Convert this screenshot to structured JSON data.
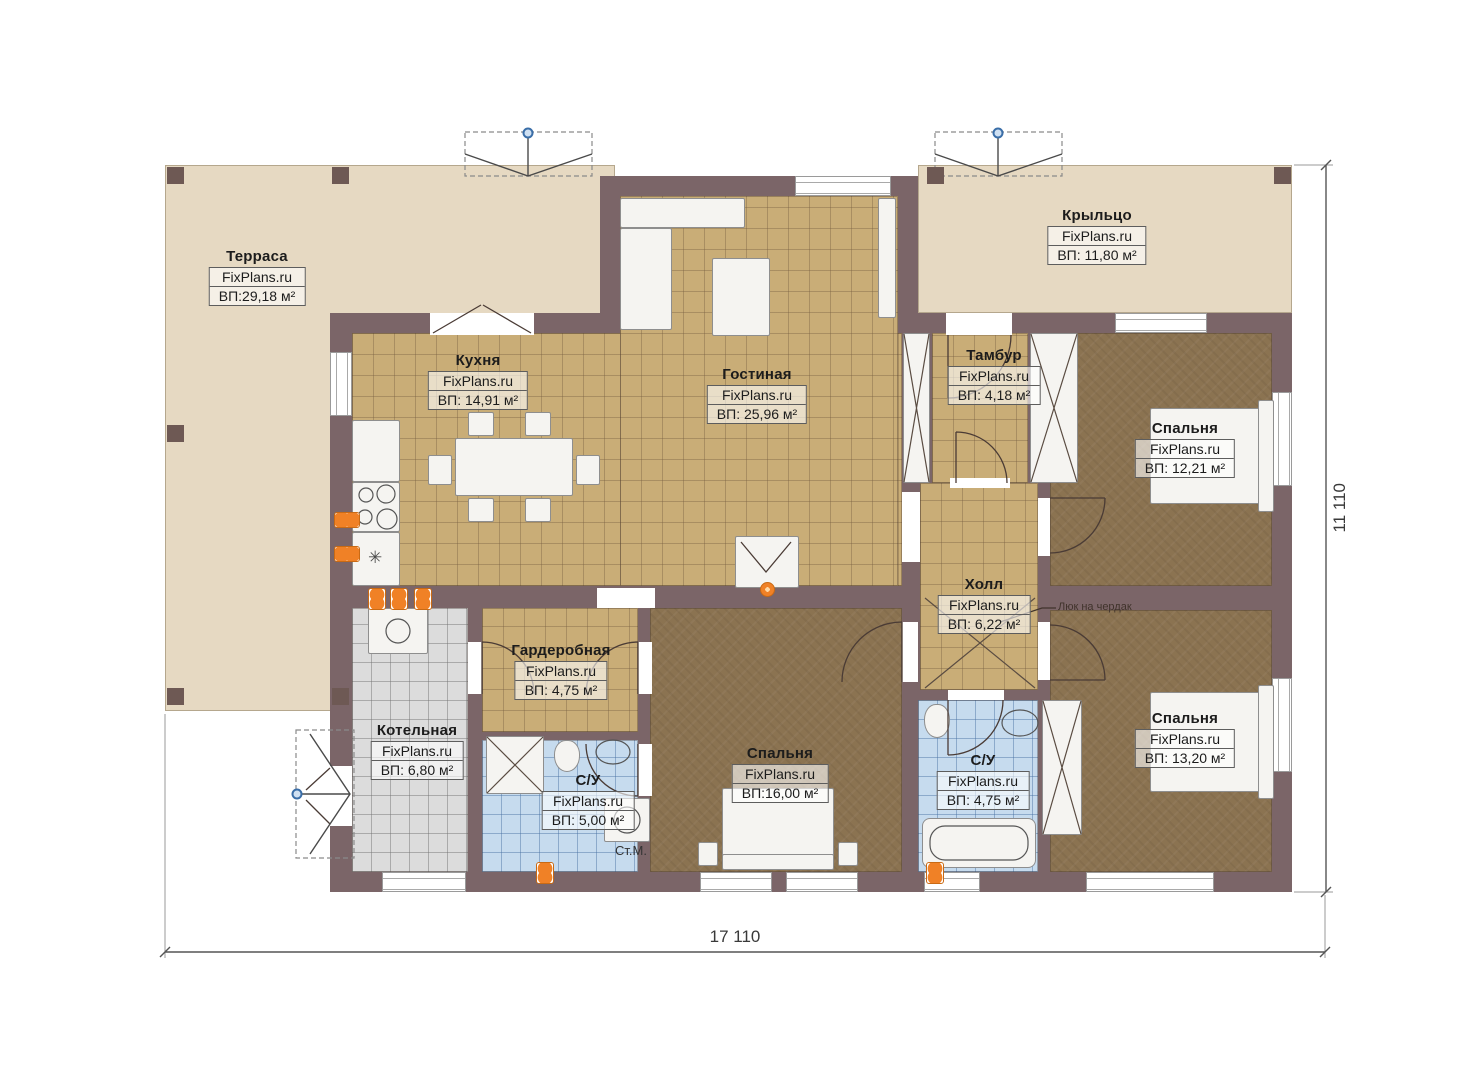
{
  "plan": {
    "brand": "FixPlans.ru",
    "rooms": [
      {
        "key": "terrace",
        "name": "Терраса",
        "area": "ВП:29,18 м²"
      },
      {
        "key": "porch",
        "name": "Крыльцо",
        "area": "ВП: 11,80 м²"
      },
      {
        "key": "kitchen",
        "name": "Кухня",
        "area": "ВП: 14,91 м²"
      },
      {
        "key": "living",
        "name": "Гостиная",
        "area": "ВП: 25,96 м²"
      },
      {
        "key": "vestibule",
        "name": "Тамбур",
        "area": "ВП: 4,18 м²"
      },
      {
        "key": "bedroom-1",
        "name": "Спальня",
        "area": "ВП: 12,21 м²"
      },
      {
        "key": "hall",
        "name": "Холл",
        "area": "ВП: 6,22 м²"
      },
      {
        "key": "wardrobe",
        "name": "Гардеробная",
        "area": "ВП: 4,75 м²"
      },
      {
        "key": "boiler",
        "name": "Котельная",
        "area": "ВП: 6,80 м²"
      },
      {
        "key": "bath-1",
        "name": "С/У",
        "area": "ВП: 5,00 м²"
      },
      {
        "key": "bedroom-2",
        "name": "Спальня",
        "area": "ВП:16,00 м²"
      },
      {
        "key": "bath-2",
        "name": "С/У",
        "area": "ВП: 4,75 м²"
      },
      {
        "key": "bedroom-3",
        "name": "Спальня",
        "area": "ВП: 13,20 м²"
      }
    ],
    "annotations": {
      "attic_hatch": "Люк на чердак",
      "washing_machine": "Ст.М."
    },
    "dimensions": {
      "horizontal": "17 110",
      "vertical": "11 110"
    },
    "colors": {
      "wall": "#7b6568",
      "terrace": "#e6d9c2",
      "tile_floor": "#c9ad77",
      "bedroom_floor": "#8b7351",
      "bathroom_floor": "#c6dbee",
      "boiler_floor": "#dcdcdc",
      "radiator": "#f08126",
      "marker_blue": "#3a6ea8"
    }
  }
}
